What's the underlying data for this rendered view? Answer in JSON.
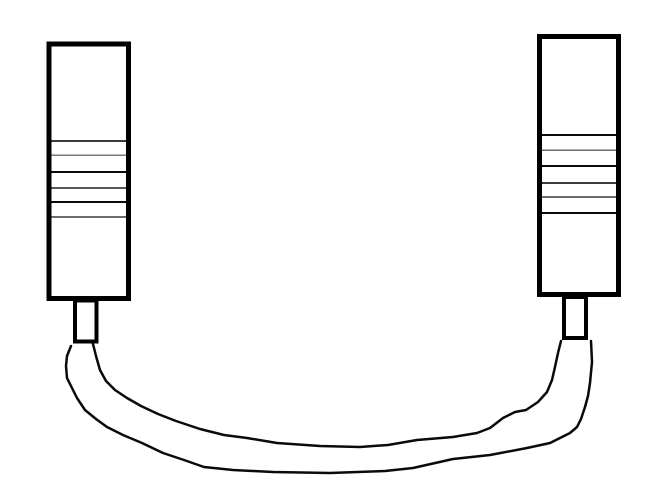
{
  "diagram": {
    "title": "Hand-drawn cable with two striped connectors joined by a curved cord",
    "background_color": "#ffffff",
    "ink_color": "#000000",
    "canvas": {
      "width": 659,
      "height": 490
    },
    "connectors": [
      {
        "id": "left-connector",
        "body": {
          "x": 46.5,
          "y": 41.5,
          "width": 84.5,
          "height": 259.5,
          "stroke_width": 5
        },
        "ridge_lines": [
          {
            "y": 141,
            "color": "#3c3c3c",
            "width": 2
          },
          {
            "y": 155,
            "color": "#7a7a7a",
            "width": 1.5
          },
          {
            "y": 172,
            "color": "#0a0a0a",
            "width": 2
          },
          {
            "y": 188,
            "color": "#565656",
            "width": 2
          },
          {
            "y": 202,
            "color": "#0a0a0a",
            "width": 2
          },
          {
            "y": 217,
            "color": "#6b6b6b",
            "width": 2
          }
        ],
        "neck": {
          "x": 73,
          "y": 298.5,
          "width": 25.5,
          "height": 45,
          "stroke_width": 4
        }
      },
      {
        "id": "right-connector",
        "body": {
          "x": 537,
          "y": 34,
          "width": 84,
          "height": 263,
          "stroke_width": 5
        },
        "ridge_lines": [
          {
            "y": 135,
            "color": "#0a0a0a",
            "width": 2
          },
          {
            "y": 150,
            "color": "#6b6b6b",
            "width": 1.5
          },
          {
            "y": 166,
            "color": "#0a0a0a",
            "width": 2
          },
          {
            "y": 183,
            "color": "#3c3c3c",
            "width": 2
          },
          {
            "y": 197,
            "color": "#6b6b6b",
            "width": 2
          },
          {
            "y": 213,
            "color": "#0a0a0a",
            "width": 2
          }
        ],
        "neck": {
          "x": 562,
          "y": 295,
          "width": 26,
          "height": 45,
          "stroke_width": 4
        }
      }
    ],
    "cable": {
      "stroke_width": 2.5,
      "stroke_color": "#0a0a0a",
      "outer_points": [
        [
          71,
          346
        ],
        [
          67,
          356
        ],
        [
          66,
          366
        ],
        [
          67,
          378
        ],
        [
          71,
          386
        ],
        [
          77,
          398
        ],
        [
          85,
          410
        ],
        [
          96,
          419
        ],
        [
          107,
          427
        ],
        [
          123,
          435
        ],
        [
          142,
          443
        ],
        [
          163,
          453
        ],
        [
          184,
          460
        ],
        [
          204,
          467
        ],
        [
          233,
          470
        ],
        [
          273,
          472
        ],
        [
          330,
          473
        ],
        [
          385,
          471
        ],
        [
          413,
          468
        ],
        [
          453,
          459
        ],
        [
          490,
          455
        ],
        [
          527,
          448
        ],
        [
          550,
          443
        ],
        [
          570,
          433
        ],
        [
          577,
          427
        ],
        [
          581,
          419
        ],
        [
          585,
          407
        ],
        [
          588,
          396
        ],
        [
          590,
          383
        ],
        [
          592,
          362
        ],
        [
          591,
          341
        ]
      ],
      "inner_points": [
        [
          93,
          344
        ],
        [
          96,
          356
        ],
        [
          100,
          370
        ],
        [
          106,
          381
        ],
        [
          115,
          390
        ],
        [
          127,
          398
        ],
        [
          141,
          406
        ],
        [
          158,
          414
        ],
        [
          176,
          421
        ],
        [
          200,
          429
        ],
        [
          224,
          435
        ],
        [
          247,
          438
        ],
        [
          277,
          443
        ],
        [
          320,
          446
        ],
        [
          360,
          447
        ],
        [
          388,
          445
        ],
        [
          417,
          440
        ],
        [
          453,
          437
        ],
        [
          477,
          433
        ],
        [
          490,
          428
        ],
        [
          503,
          418
        ],
        [
          515,
          412
        ],
        [
          526,
          410
        ],
        [
          538,
          402
        ],
        [
          547,
          392
        ],
        [
          552,
          380
        ],
        [
          555,
          367
        ],
        [
          558,
          353
        ],
        [
          561,
          341
        ]
      ]
    }
  }
}
